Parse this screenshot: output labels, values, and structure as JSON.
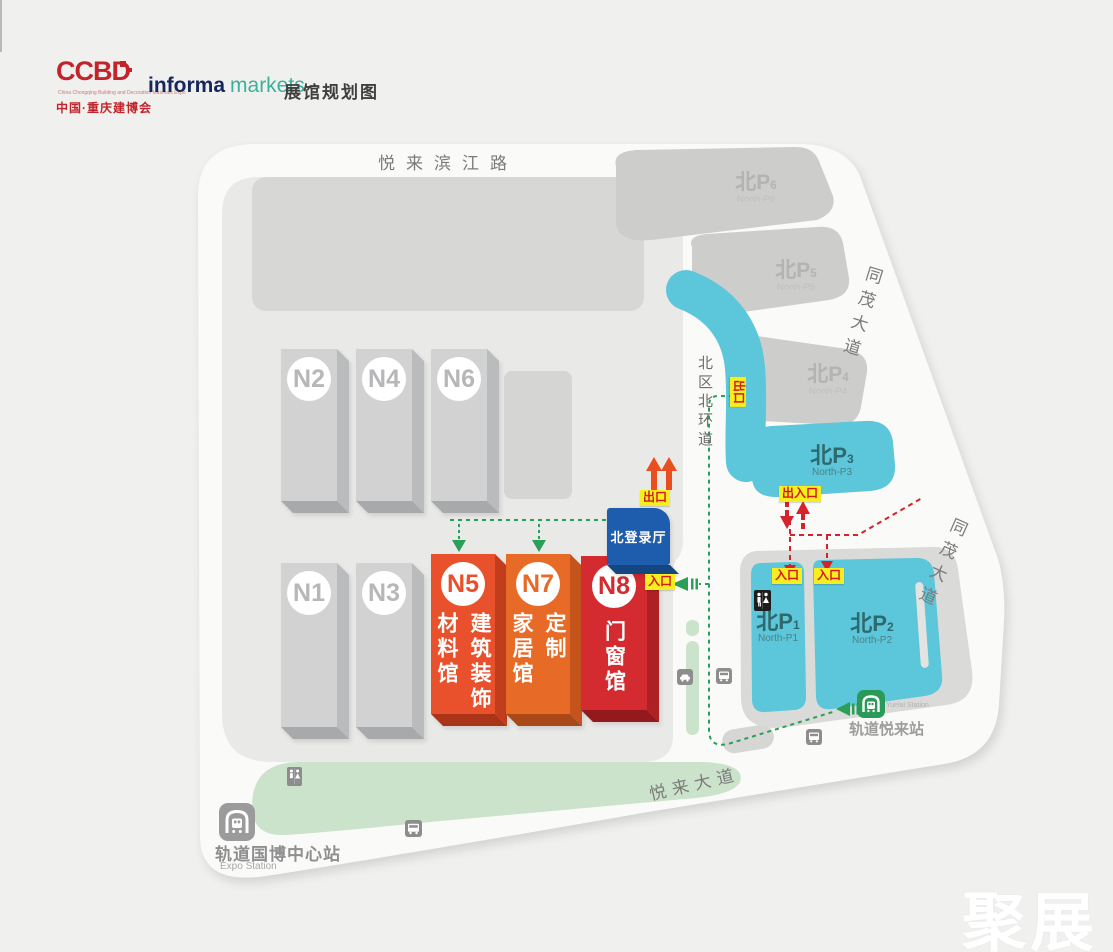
{
  "header": {
    "logo_main": "CCBD",
    "logo_tagline": "China Chongqing Building and Decoration Materials Expo",
    "logo_cn": "中国·重庆建博会",
    "brand_informa": "informa",
    "brand_markets": "markets",
    "page_title": "展馆规划图"
  },
  "roads": {
    "binjiang": "悦来滨江路",
    "tongmao_upper": "同茂大道",
    "tongmao_lower": "同茂大道",
    "north_ring": "北区北环道",
    "yuelai": "悦来大道"
  },
  "halls": {
    "n1": "N1",
    "n2": "N2",
    "n3": "N3",
    "n4": "N4",
    "n6": "N6",
    "n5": {
      "id": "N5",
      "col_right": "建筑装饰",
      "col_left": "材料馆"
    },
    "n7": {
      "id": "N7",
      "col_right": "定制",
      "col_left": "家居馆"
    },
    "n8": {
      "id": "N8",
      "col": "门窗馆"
    },
    "registration": "北登录厅"
  },
  "parking": {
    "p6": {
      "cn": "北",
      "letter": "P",
      "num": "6",
      "sub": "North-P6"
    },
    "p5": {
      "cn": "北",
      "letter": "P",
      "num": "5",
      "sub": "North-P5"
    },
    "p4": {
      "cn": "北",
      "letter": "P",
      "num": "4",
      "sub": "North-P4"
    },
    "p3": {
      "cn": "北",
      "letter": "P",
      "num": "3",
      "sub": "North-P3"
    },
    "p1": {
      "cn": "北",
      "letter": "P",
      "num": "1",
      "sub": "North-P1"
    },
    "p2": {
      "cn": "北",
      "letter": "P",
      "num": "2",
      "sub": "North-P2"
    }
  },
  "tags": {
    "exit_top": "出口",
    "exit_side": "出口",
    "entrance_n8": "入口",
    "exit_entrance": "出入口",
    "entrance_p1": "入口",
    "entrance_p2": "入口"
  },
  "stations": {
    "yuelai": {
      "cn": "轨道悦来站",
      "en": "Yuelai Station"
    },
    "expo": {
      "cn": "轨道国博中心站",
      "en": "Expo Station"
    }
  },
  "watermark": "聚展",
  "colors": {
    "hall_n5": "#e8512c",
    "hall_n7": "#e76b27",
    "hall_n8": "#d32b2f",
    "registration_blue": "#1e5cad",
    "parking_cyan": "#5cc6da",
    "route_green": "#2b9e57",
    "route_red": "#d6232b",
    "tag_yellow": "#f6ee1e"
  }
}
